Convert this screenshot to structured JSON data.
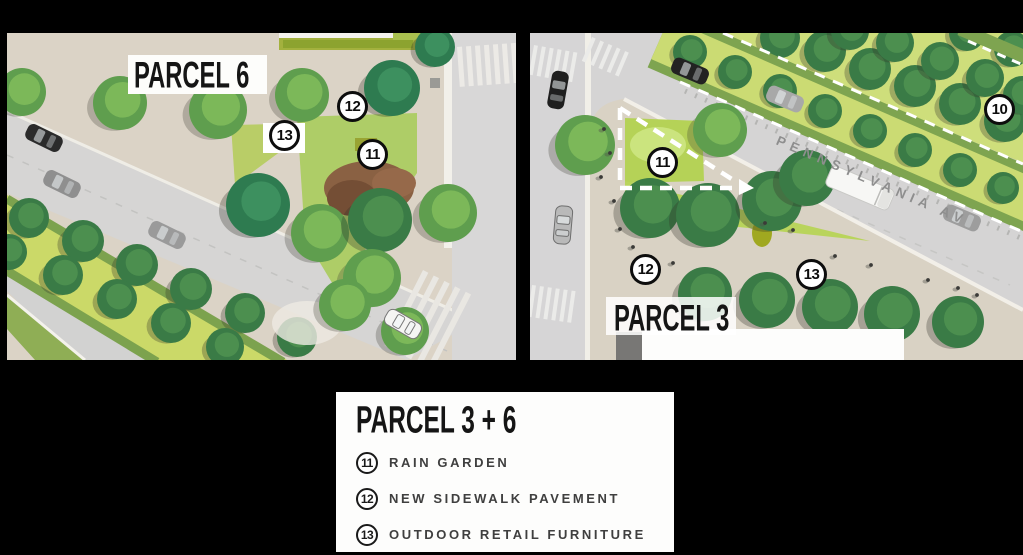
{
  "background_color": "#000000",
  "panels": {
    "parcel6": {
      "title": "PARCEL 6",
      "callouts": [
        {
          "num": "12"
        },
        {
          "num": "13"
        },
        {
          "num": "11"
        }
      ]
    },
    "parcel3": {
      "title": "PARCEL 3",
      "street_name": "PENNSYLVANIA AV",
      "callouts": [
        {
          "num": "10"
        },
        {
          "num": "11"
        },
        {
          "num": "12"
        },
        {
          "num": "13"
        }
      ]
    }
  },
  "legend": {
    "title": "PARCEL 3 + 6",
    "items": [
      {
        "num": "11",
        "label": "RAIN GARDEN"
      },
      {
        "num": "12",
        "label": "NEW SIDEWALK PAVEMENT"
      },
      {
        "num": "13",
        "label": "OUTDOOR RETAIL FURNITURE"
      }
    ]
  },
  "colors": {
    "plaza": "#dbd3c6",
    "street": "#d6d5d4",
    "median_lime": "#cbd968",
    "median_edge": "#7ca24e",
    "park_lime": "#cede7b",
    "lawn": "#aecd67",
    "tree_light": "#5f9e4e",
    "tree_dark": "#3a7b46",
    "tree_teal": "#2e7b50",
    "mulch_brown": "#8a6143",
    "callout_ring": "#0d0d0d",
    "street_text": "#8e8e8e"
  }
}
